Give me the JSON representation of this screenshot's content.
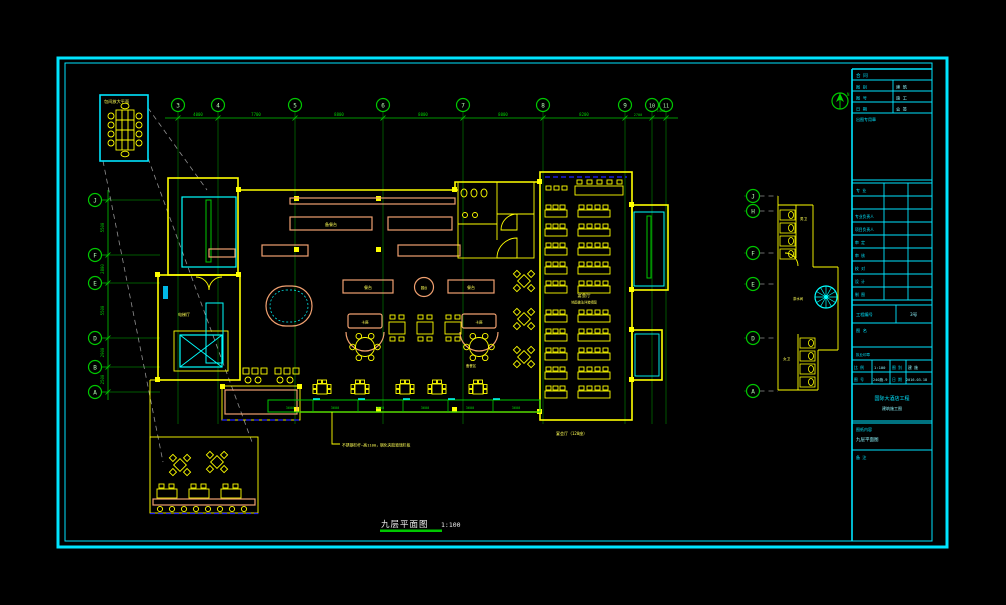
{
  "sheet": {
    "title": "九层平面图",
    "scale": "1:100"
  },
  "grid": {
    "top": [
      "3",
      "4",
      "5",
      "6",
      "7",
      "8",
      "9",
      "10",
      "11"
    ],
    "left": [
      "J",
      "F",
      "E",
      "D",
      "B",
      "A"
    ],
    "right": [
      "J",
      "H",
      "F",
      "E",
      "D",
      "A"
    ]
  },
  "dims": {
    "top": [
      "4000",
      "7700",
      "8800",
      "8000",
      "8000",
      "8200",
      "2700",
      "1400"
    ],
    "left": [
      "5500",
      "2800",
      "5500",
      "2900",
      "2500"
    ],
    "band": [
      "3600",
      "3600",
      "3600",
      "3600",
      "3600",
      "3600"
    ]
  },
  "labels": {
    "detail": "包间放大平面",
    "pantry": "备餐台",
    "table1": "餐台",
    "table2": "餐台",
    "round": "圆台",
    "booth1": "卡座",
    "booth2": "卡座",
    "hall": "宴会厅",
    "hall_note": "地面做法详装修图",
    "hall_seats": "宴会厅（120座）",
    "service": "备餐区",
    "elev_hall": "电梯厅",
    "wc_m": "男卫",
    "wc_f": "女卫",
    "tea": "茶水间",
    "railing": "不锈钢栏杆—高1100，钢化夹胶玻璃栏板"
  },
  "title_block": {
    "row1": "合 同",
    "rows": [
      {
        "l": "图 别",
        "r": "建 筑"
      },
      {
        "l": "图 号",
        "r": "施 工"
      },
      {
        "l": "日 期",
        "r": "会 签"
      }
    ],
    "stamp": "出图专用章",
    "sign_header": "专 业",
    "persons": [
      "专业负责人",
      "项目负责人",
      "审 定",
      "审 核",
      "校 对",
      "设 计",
      "制 图"
    ],
    "project_no_label": "工程编号",
    "project_no": "3号",
    "fig_label": "图 名",
    "seal": "执业印章",
    "scale_label": "比 例",
    "scale": "1:100",
    "type_label": "图 别",
    "type": "建 施",
    "no_label": "图 号",
    "no": "240施-9",
    "date_label": "日 期",
    "date": "2016.03.18",
    "project1": "国际大酒店工程",
    "project2": "建筑施工图",
    "content_label": "图纸内容",
    "content": "九层平面图",
    "note": "备 注"
  },
  "north_label": "N",
  "colors": {
    "frame": "#00E5FF",
    "grid": "#00C800",
    "wall": "#FFFF00",
    "counter": "#F0A070",
    "stair": "#00FFFF",
    "accent_blue": "#2323FF"
  }
}
